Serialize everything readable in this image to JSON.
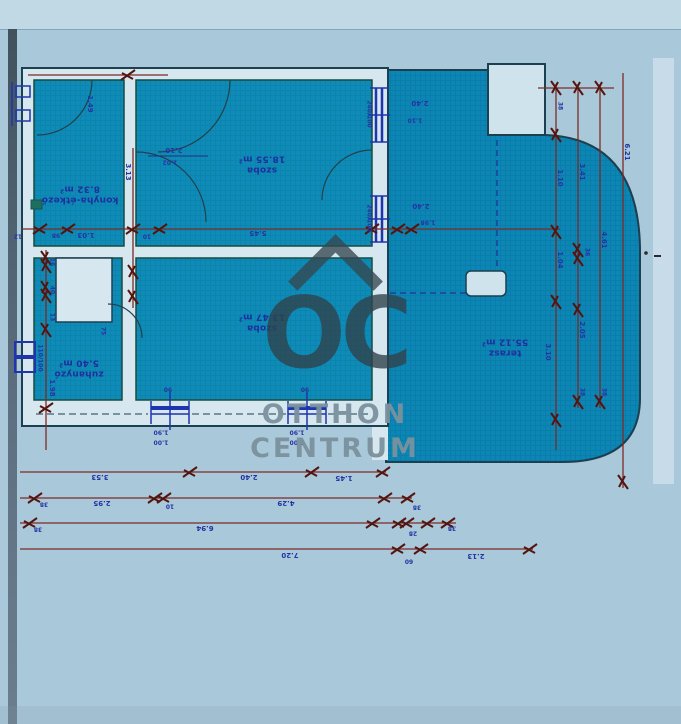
{
  "watermark": {
    "logo_text": "OC",
    "line1": "OTTHON",
    "line2": "CENTRUM"
  },
  "rooms": [
    {
      "id": "szoba-felso",
      "name": "szoba",
      "area": "18.55 m²",
      "x": 262,
      "y": 163
    },
    {
      "id": "szoba-also",
      "name": "szoba",
      "area": "13.47 m²",
      "x": 262,
      "y": 321
    },
    {
      "id": "konyha-etkezo",
      "name": "konyha-étkező",
      "area": "8.32 m²",
      "x": 80,
      "y": 193
    },
    {
      "id": "zuhanyzo",
      "name": "zuhanyzó",
      "area": "5.40 m²",
      "x": 79,
      "y": 367
    },
    {
      "id": "terasz",
      "name": "terasz",
      "area": "55.12 m²",
      "x": 505,
      "y": 346
    }
  ],
  "plan_labels": [
    {
      "t": "2.10",
      "x": 174,
      "y": 150,
      "r": 180,
      "s": 7
    },
    {
      "t": "1.02",
      "x": 170,
      "y": 162,
      "r": 180,
      "s": 6
    },
    {
      "t": "3.13",
      "x": 128,
      "y": 172,
      "r": 90,
      "s": 7
    },
    {
      "t": "1.49",
      "x": 90,
      "y": 104,
      "r": 90,
      "s": 7
    },
    {
      "t": "12",
      "x": 18,
      "y": 236,
      "r": 180,
      "s": 6
    },
    {
      "t": "98",
      "x": 56,
      "y": 235,
      "r": 180,
      "s": 6
    },
    {
      "t": "1.03",
      "x": 86,
      "y": 235,
      "r": 180,
      "s": 7
    },
    {
      "t": "10",
      "x": 147,
      "y": 236,
      "r": 180,
      "s": 6
    },
    {
      "t": "5.45",
      "x": 258,
      "y": 233,
      "r": 180,
      "s": 7
    },
    {
      "t": "16",
      "x": 52,
      "y": 262,
      "r": 90,
      "s": 6
    },
    {
      "t": "40",
      "x": 52,
      "y": 290,
      "r": 90,
      "s": 6
    },
    {
      "t": "13",
      "x": 52,
      "y": 317,
      "r": 90,
      "s": 6
    },
    {
      "t": "75",
      "x": 103,
      "y": 331,
      "r": 90,
      "s": 6
    },
    {
      "t": "1.98",
      "x": 52,
      "y": 388,
      "r": 90,
      "s": 7
    },
    {
      "t": "110/100",
      "x": 40,
      "y": 358,
      "r": 90,
      "s": 6
    },
    {
      "t": "240/100",
      "x": 369,
      "y": 114,
      "r": 90,
      "s": 6
    },
    {
      "t": "2.40",
      "x": 420,
      "y": 103,
      "r": 180,
      "s": 7
    },
    {
      "t": "1.10",
      "x": 415,
      "y": 120,
      "r": 180,
      "s": 6
    },
    {
      "t": "240/100",
      "x": 369,
      "y": 218,
      "r": 90,
      "s": 6
    },
    {
      "t": "2.40",
      "x": 421,
      "y": 206,
      "r": 180,
      "s": 7
    },
    {
      "t": "1.98",
      "x": 428,
      "y": 222,
      "r": 180,
      "s": 6
    },
    {
      "t": "90",
      "x": 168,
      "y": 389,
      "r": 180,
      "s": 6
    },
    {
      "t": "90",
      "x": 305,
      "y": 389,
      "r": 180,
      "s": 6
    },
    {
      "t": "1.90",
      "x": 161,
      "y": 432,
      "r": 180,
      "s": 6
    },
    {
      "t": "1.00",
      "x": 161,
      "y": 442,
      "r": 180,
      "s": 6
    },
    {
      "t": "1.90",
      "x": 297,
      "y": 432,
      "r": 180,
      "s": 6
    },
    {
      "t": "1.00",
      "x": 297,
      "y": 442,
      "r": 180,
      "s": 6
    },
    {
      "t": "3.53",
      "x": 100,
      "y": 477,
      "r": 180,
      "s": 7
    },
    {
      "t": "2.40",
      "x": 249,
      "y": 477,
      "r": 180,
      "s": 7
    },
    {
      "t": "1.45",
      "x": 344,
      "y": 478,
      "r": 180,
      "s": 7
    },
    {
      "t": "38",
      "x": 44,
      "y": 504,
      "r": 180,
      "s": 6
    },
    {
      "t": "2.95",
      "x": 102,
      "y": 503,
      "r": 180,
      "s": 7
    },
    {
      "t": "10",
      "x": 170,
      "y": 506,
      "r": 180,
      "s": 6
    },
    {
      "t": "4.29",
      "x": 286,
      "y": 503,
      "r": 180,
      "s": 7
    },
    {
      "t": "38",
      "x": 417,
      "y": 507,
      "r": 180,
      "s": 6
    },
    {
      "t": "38",
      "x": 38,
      "y": 529,
      "r": 180,
      "s": 6
    },
    {
      "t": "6.94",
      "x": 205,
      "y": 528,
      "r": 180,
      "s": 7
    },
    {
      "t": "28",
      "x": 413,
      "y": 533,
      "r": 180,
      "s": 6
    },
    {
      "t": "38",
      "x": 452,
      "y": 528,
      "r": 180,
      "s": 6
    },
    {
      "t": "7.20",
      "x": 290,
      "y": 555,
      "r": 180,
      "s": 7
    },
    {
      "t": "60",
      "x": 409,
      "y": 561,
      "r": 180,
      "s": 6
    },
    {
      "t": "2.13",
      "x": 476,
      "y": 556,
      "r": 180,
      "s": 7
    },
    {
      "t": "38",
      "x": 560,
      "y": 106,
      "r": 90,
      "s": 6
    },
    {
      "t": "1.10",
      "x": 560,
      "y": 178,
      "r": 90,
      "s": 7
    },
    {
      "t": "1.04",
      "x": 560,
      "y": 260,
      "r": 90,
      "s": 7
    },
    {
      "t": "3.10",
      "x": 548,
      "y": 352,
      "r": 90,
      "s": 7
    },
    {
      "t": "3.41",
      "x": 582,
      "y": 172,
      "r": 90,
      "s": 7
    },
    {
      "t": "36",
      "x": 587,
      "y": 252,
      "r": 90,
      "s": 6
    },
    {
      "t": "2.05",
      "x": 582,
      "y": 330,
      "r": 90,
      "s": 7
    },
    {
      "t": "4.61",
      "x": 604,
      "y": 240,
      "r": 90,
      "s": 7
    },
    {
      "t": "6.21",
      "x": 627,
      "y": 152,
      "r": 90,
      "s": 7
    },
    {
      "t": "38",
      "x": 582,
      "y": 392,
      "r": 90,
      "s": 6
    },
    {
      "t": "38",
      "x": 604,
      "y": 392,
      "r": 90,
      "s": 6
    }
  ],
  "colors": {
    "paper": "#a9c8da",
    "room_fill": "#0e8cb8",
    "wall_fill": "#d6e7ef",
    "outline": "#1c4050",
    "dim_line": "#7c2b26",
    "dim_text": "#2633a2",
    "window_blue": "#1e35ad"
  }
}
